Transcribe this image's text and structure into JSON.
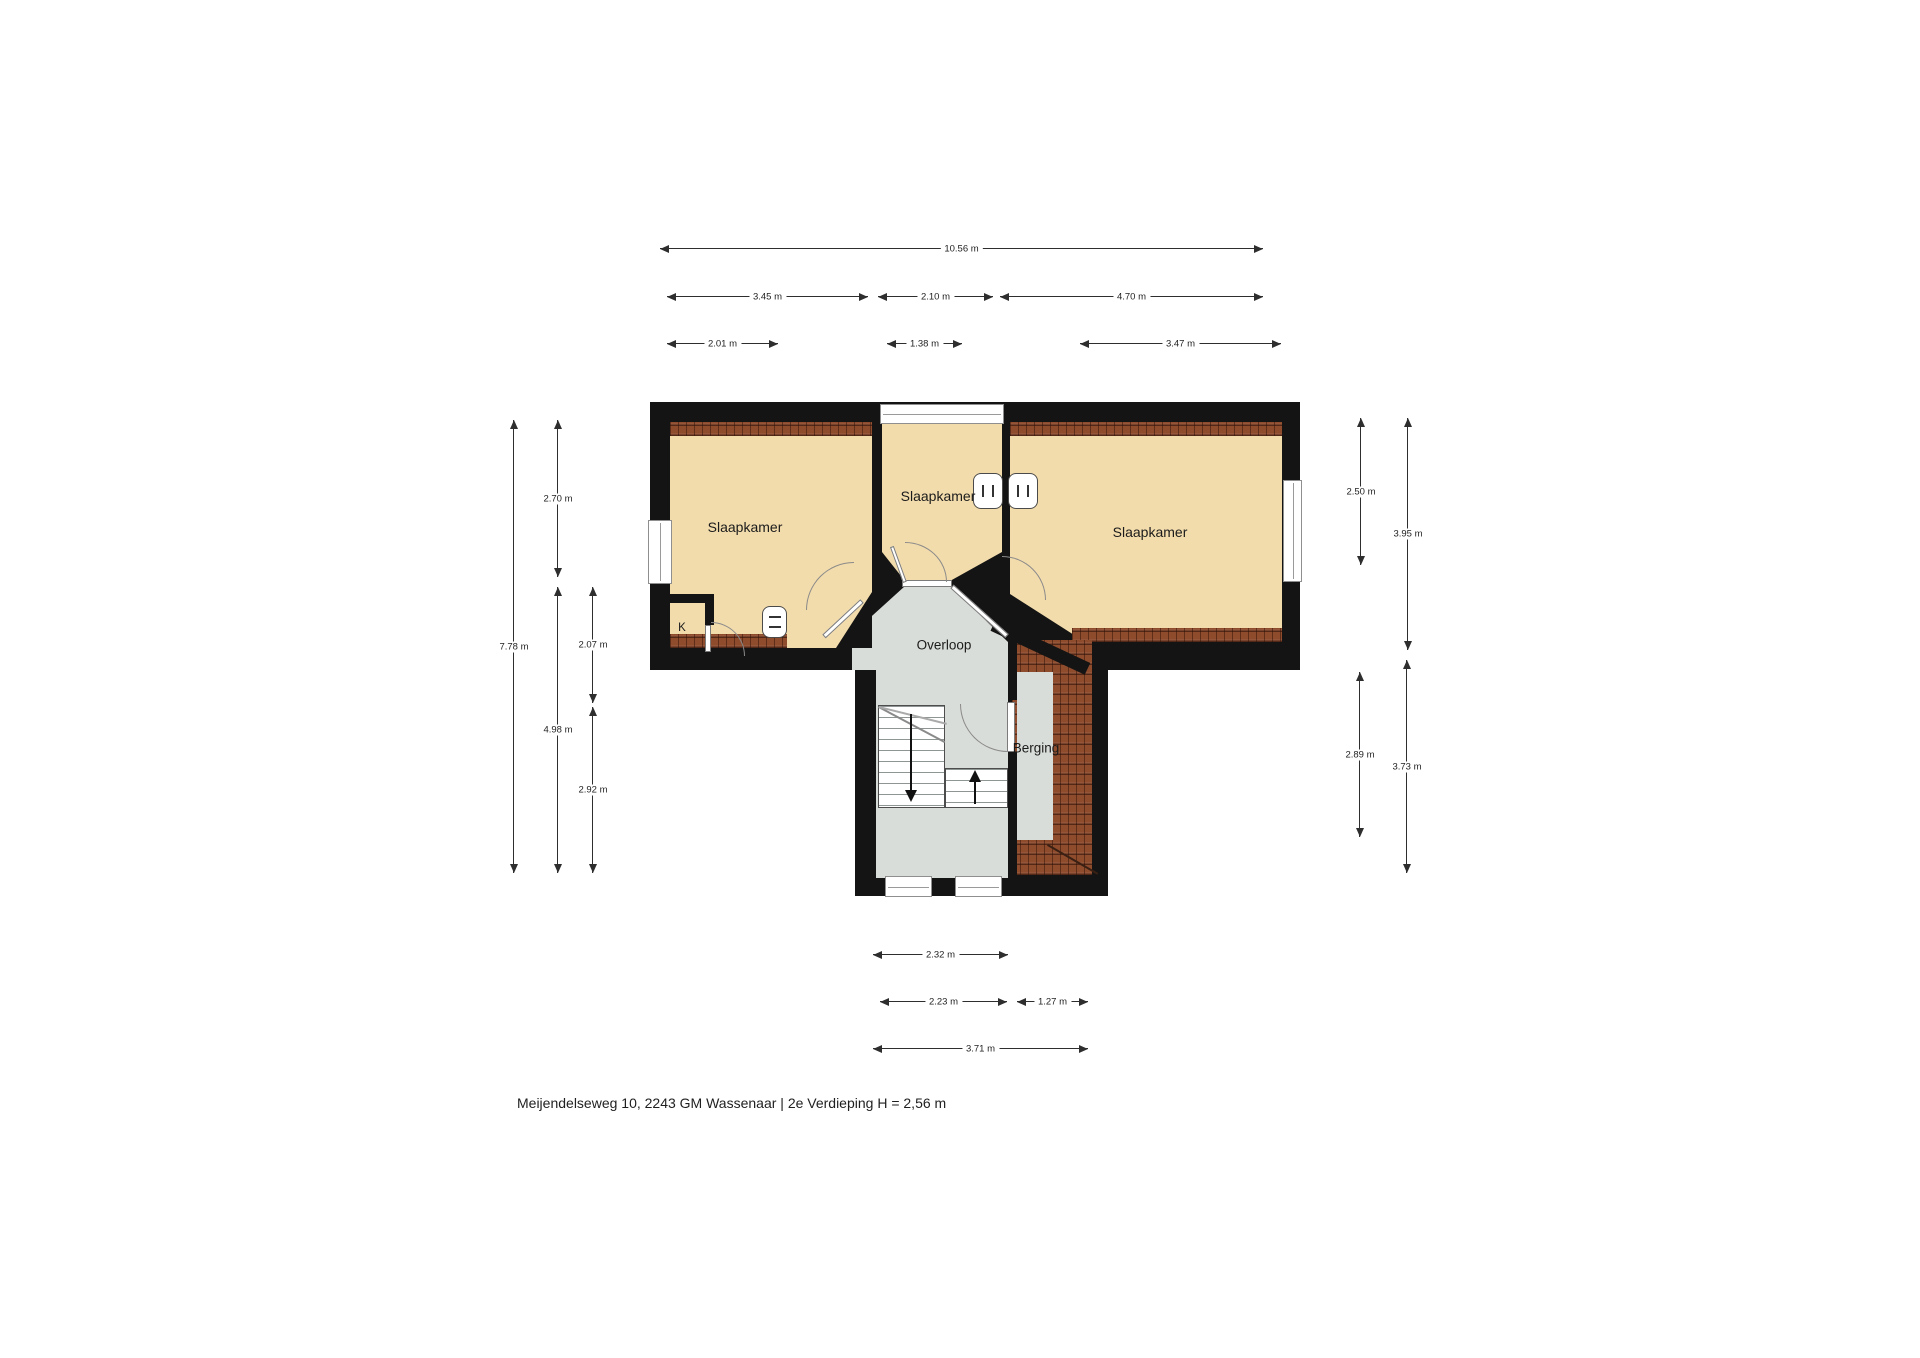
{
  "address_caption": "Meijendelseweg 10, 2243 GM Wassenaar | 2e Verdieping H = 2,56 m",
  "rooms": {
    "left_bedroom": "Slaapkamer",
    "middle_bedroom": "Slaapkamer",
    "right_bedroom": "Slaapkamer",
    "landing": "Overloop",
    "storage": "Berging",
    "closet": "K"
  },
  "dimensions": [
    {
      "side": "top",
      "label": "10.56 m"
    },
    {
      "side": "top",
      "label": "3.45 m"
    },
    {
      "side": "top",
      "label": "2.10 m"
    },
    {
      "side": "top",
      "label": "4.70 m"
    },
    {
      "side": "top",
      "label": "2.01 m"
    },
    {
      "side": "top",
      "label": "1.38 m"
    },
    {
      "side": "top",
      "label": "3.47 m"
    },
    {
      "side": "left",
      "label": "7.78 m"
    },
    {
      "side": "left",
      "label": "2.70 m"
    },
    {
      "side": "left",
      "label": "4.98 m"
    },
    {
      "side": "left",
      "label": "2.07 m"
    },
    {
      "side": "left",
      "label": "2.92 m"
    },
    {
      "side": "right",
      "label": "2.50 m"
    },
    {
      "side": "right",
      "label": "3.95 m"
    },
    {
      "side": "right",
      "label": "2.89 m"
    },
    {
      "side": "right",
      "label": "3.73 m"
    },
    {
      "side": "bottom",
      "label": "2.32 m"
    },
    {
      "side": "bottom",
      "label": "2.23 m"
    },
    {
      "side": "bottom",
      "label": "1.27 m"
    },
    {
      "side": "bottom",
      "label": "3.71 m"
    }
  ],
  "colors": {
    "wall": "#141414",
    "bedroom_floor": "#f3dcac",
    "hall_floor": "#d9ddd9",
    "roof_hatch": "#8e4c2d",
    "dimension_line": "#2e2e2e"
  }
}
